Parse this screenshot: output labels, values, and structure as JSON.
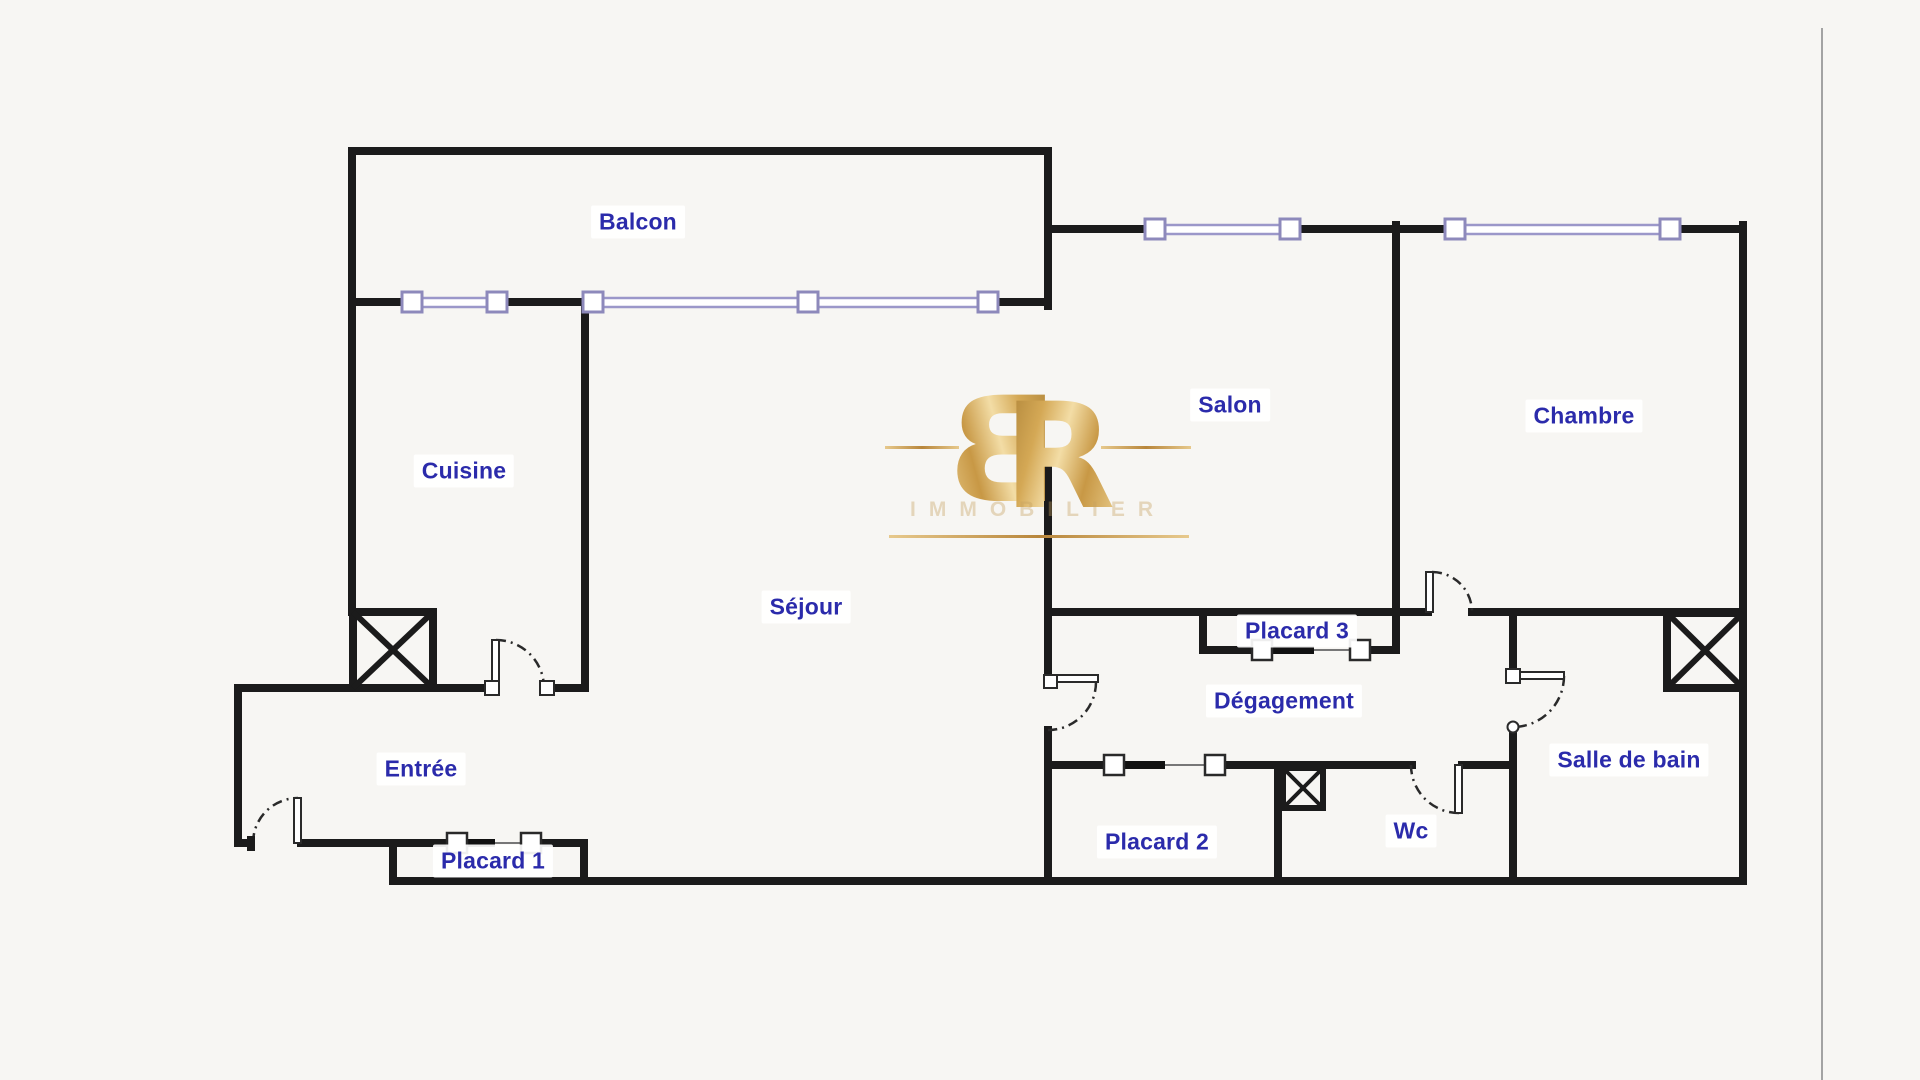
{
  "rooms": {
    "balcon": {
      "label": "Balcon"
    },
    "cuisine": {
      "label": "Cuisine"
    },
    "sejour": {
      "label": "Séjour"
    },
    "salon": {
      "label": "Salon"
    },
    "chambre": {
      "label": "Chambre"
    },
    "entree": {
      "label": "Entrée"
    },
    "placard1": {
      "label": "Placard 1"
    },
    "placard2": {
      "label": "Placard 2"
    },
    "placard3": {
      "label": "Placard 3"
    },
    "degagement": {
      "label": "Dégagement"
    },
    "wc": {
      "label": "Wc"
    },
    "salle_de_bain": {
      "label": "Salle de bain"
    }
  },
  "watermark": {
    "letter_b": "B",
    "letter_r": "R",
    "tagline": "IMMOBILIER"
  },
  "colors": {
    "wall": "#1b1b1b",
    "window_line": "#9b97c9",
    "window_square_border": "#8d89bb",
    "door_line": "#2a2a2a",
    "label_text": "#2b2bab",
    "label_background": "#ffffff",
    "background": "#f7f6f3",
    "watermark_gold": "#c99b4f",
    "page_edge": "#a3a3a3"
  }
}
